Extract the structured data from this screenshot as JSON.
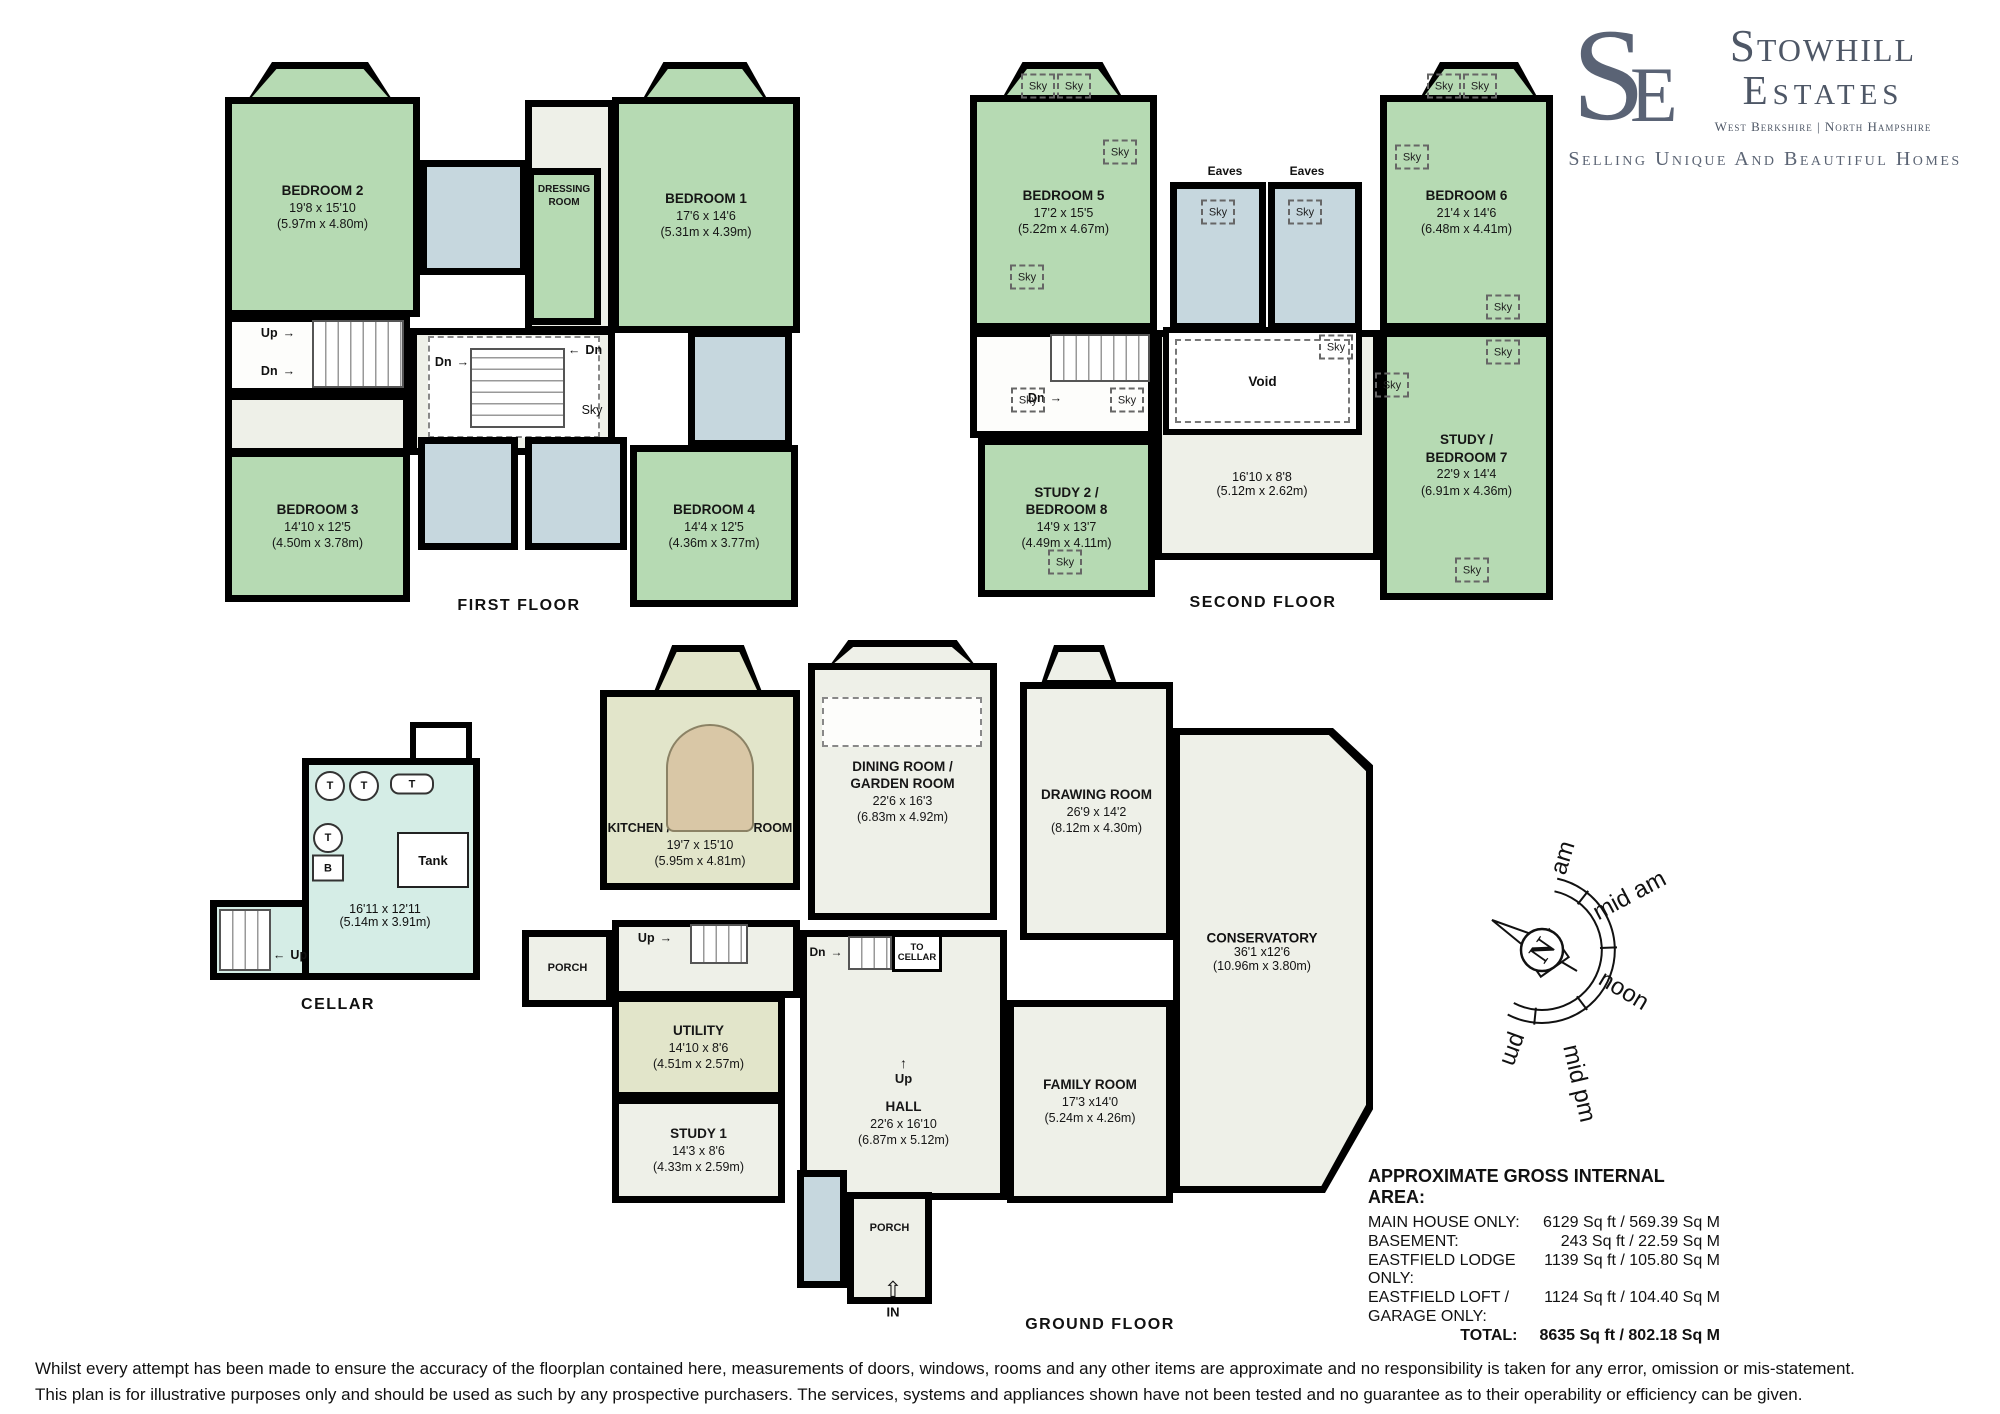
{
  "logo": {
    "monogram_s": "S",
    "monogram_e": "E",
    "name_line1": "Stowhill",
    "name_line2": "Estates",
    "region": "West Berkshire | North Hampshire",
    "tagline": "Selling Unique And Beautiful Homes"
  },
  "labels": {
    "sky": "Sky",
    "eaves": "Eaves",
    "up": "Up",
    "dn": "Dn",
    "arrow_right": "→",
    "arrow_left": "←",
    "arrow_up": "↑",
    "in_arrow": "⇧"
  },
  "floors": {
    "first": {
      "caption": "FIRST FLOOR",
      "rooms": [
        {
          "name": "BEDROOM 2",
          "dims_ft": "19'8 x 15'10",
          "dims_m": "(5.97m x 4.80m)"
        },
        {
          "name": "DRESSING",
          "name2": "ROOM"
        },
        {
          "name": "BEDROOM 1",
          "dims_ft": "17'6 x 14'6",
          "dims_m": "(5.31m x 4.39m)"
        },
        {
          "name": "BEDROOM 3",
          "dims_ft": "14'10 x 12'5",
          "dims_m": "(4.50m x 3.78m)"
        },
        {
          "name": "BEDROOM 4",
          "dims_ft": "14'4 x 12'5",
          "dims_m": "(4.36m x 3.77m)"
        }
      ]
    },
    "second": {
      "caption": "SECOND FLOOR",
      "rooms": [
        {
          "name": "BEDROOM 5",
          "dims_ft": "17'2 x 15'5",
          "dims_m": "(5.22m x 4.67m)"
        },
        {
          "name": "BEDROOM 6",
          "dims_ft": "21'4 x 14'6",
          "dims_m": "(6.48m x 4.41m)"
        },
        {
          "name": "STUDY 2 /",
          "name2": "BEDROOM 8",
          "dims_ft": "14'9 x 13'7",
          "dims_m": "(4.49m x 4.11m)"
        },
        {
          "name": "STUDY /",
          "name2": "BEDROOM 7",
          "dims_ft": "22'9 x 14'4",
          "dims_m": "(6.91m x 4.36m)"
        },
        {
          "name": "Void",
          "dims_ft": "16'10 x 8'8",
          "dims_m": "(5.12m x 2.62m)"
        }
      ]
    },
    "ground": {
      "caption": "GROUND FLOOR",
      "porch": "PORCH",
      "to_cellar_1": "TO",
      "to_cellar_2": "CELLAR",
      "in_label": "IN",
      "rooms": [
        {
          "name": "KITCHEN / BREAKFAST ROOM",
          "dims_ft": "19'7 x 15'10",
          "dims_m": "(5.95m x 4.81m)"
        },
        {
          "name": "DINING ROOM /",
          "name2": "GARDEN ROOM",
          "dims_ft": "22'6 x 16'3",
          "dims_m": "(6.83m x 4.92m)"
        },
        {
          "name": "DRAWING ROOM",
          "dims_ft": "26'9 x 14'2",
          "dims_m": "(8.12m x 4.30m)"
        },
        {
          "name": "CONSERVATORY",
          "dims_ft": "36'1 x12'6",
          "dims_m": "(10.96m x 3.80m)"
        },
        {
          "name": "FAMILY ROOM",
          "dims_ft": "17'3 x14'0",
          "dims_m": "(5.24m x 4.26m)"
        },
        {
          "name": "HALL",
          "dims_ft": "22'6 x 16'10",
          "dims_m": "(6.87m x 5.12m)"
        },
        {
          "name": "UTILITY",
          "dims_ft": "14'10 x 8'6",
          "dims_m": "(4.51m x 2.57m)"
        },
        {
          "name": "STUDY 1",
          "dims_ft": "14'3 x 8'6",
          "dims_m": "(4.33m x 2.59m)"
        }
      ]
    },
    "cellar": {
      "caption": "CELLAR",
      "dims_ft": "16'11 x 12'11",
      "dims_m": "(5.14m x 3.91m)",
      "tank": "Tank",
      "t": "T",
      "b": "B"
    }
  },
  "compass": {
    "n": "N",
    "labels": [
      "am",
      "mid am",
      "noon",
      "mid pm",
      "pm"
    ]
  },
  "area_table": {
    "title": "APPROXIMATE GROSS INTERNAL AREA:",
    "rows": [
      {
        "label": "MAIN HOUSE ONLY:",
        "value": "6129 Sq ft / 569.39 Sq M"
      },
      {
        "label": "BASEMENT:",
        "value": "243 Sq ft / 22.59 Sq M"
      },
      {
        "label": "EASTFIELD LODGE ONLY:",
        "value": "1139 Sq ft / 105.80 Sq M"
      },
      {
        "label": "EASTFIELD LOFT / GARAGE ONLY:",
        "value": "1124 Sq ft / 104.40 Sq M"
      },
      {
        "label": "TOTAL:",
        "value": "8635 Sq ft / 802.18 Sq M"
      }
    ]
  },
  "disclaimer": {
    "line1": "Whilst every attempt has been made to ensure the accuracy of the floorplan contained here, measurements of doors, windows, rooms and any other items are approximate and no responsibility is taken for any error, omission or mis-statement.",
    "line2": "This plan is for illustrative purposes only and should be used as such by any prospective purchasers. The services, systems and appliances shown have not been tested and no guarantee as to their operability or efficiency can be given."
  },
  "colors": {
    "room_green": "#b6dab3",
    "room_blue": "#c6d7de",
    "room_teal": "#d5ede6",
    "room_khaki": "#e2e5ca",
    "room_cream": "#eef0e8",
    "island_tan": "#d9c7a6",
    "wall": "#000000",
    "logo_slate": "#5a6375"
  }
}
